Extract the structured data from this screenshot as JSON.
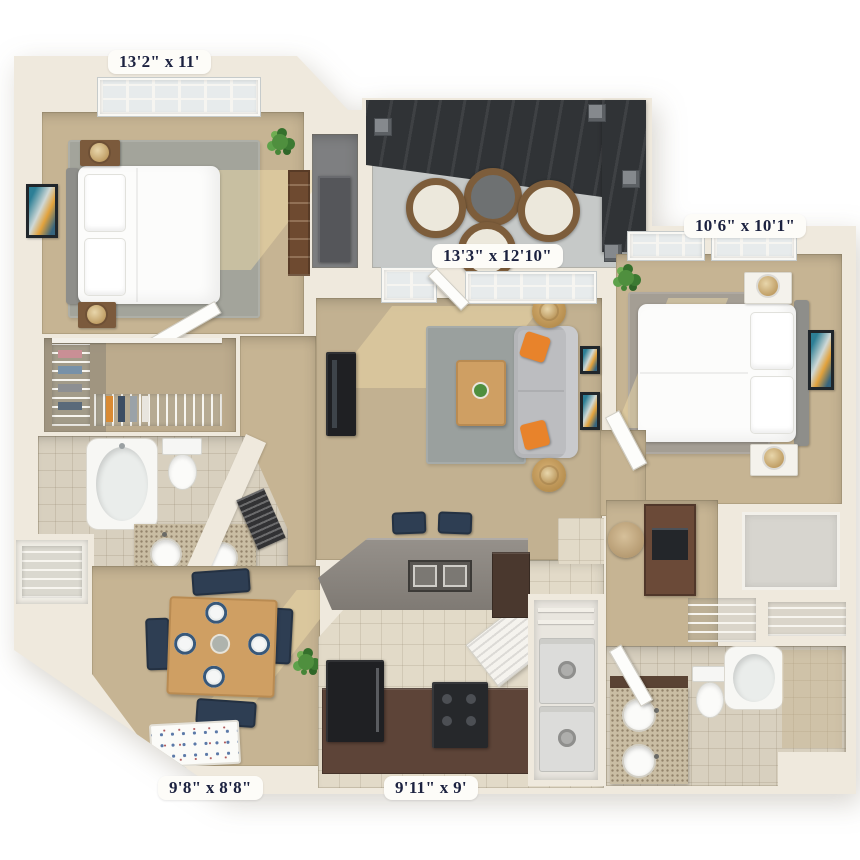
{
  "floor_plan": {
    "style": "3d-rendered top-down apartment floor plan on white background",
    "background_color": "#ffffff",
    "labels": [
      {
        "room": "bedroom-1",
        "text": "13'2\" x 11'"
      },
      {
        "room": "living-room",
        "text": "13'3\" x 12'10\""
      },
      {
        "room": "bedroom-2",
        "text": "10'6\" x 10'1\""
      },
      {
        "room": "dining-room",
        "text": "9'8\" x 8'8\""
      },
      {
        "room": "kitchen",
        "text": "9'11\" x 9'"
      }
    ],
    "label_style": {
      "text_color": "#1c2240",
      "pill_color": "#fdfcf8",
      "font": "serif bold"
    },
    "palette": {
      "walls": "#efe9dd",
      "carpet_tan": "#c6b493",
      "rug_gray": "#a3a49b",
      "kitchen_tile": "#e2dac8",
      "bath_tile": "#d8d0bf",
      "patio_concrete": "#c6c9c8",
      "pergola_dark": "#303336",
      "sofa_gray": "#bcbdc0",
      "accent_orange": "#e8832b",
      "chair_navy": "#2e3e53",
      "wood": "#cf9f63",
      "cabinet_brown": "#5d4438",
      "appliance_black": "#1f2023",
      "fixture_white": "#f7f7f4",
      "plant_green": "#4f8f3e"
    },
    "unlabeled_areas": [
      "balcony-patio-with-pergola",
      "walk-in-closet",
      "bathroom-1",
      "bathroom-2",
      "laundry-closet",
      "storage-closet",
      "entry-foyer",
      "hallway",
      "desk-nook",
      "linen-closet"
    ],
    "furnishings": {
      "bedroom_1": [
        "queen-bed",
        "two-nightstands",
        "lamps",
        "wall-art",
        "bookcase",
        "plant",
        "window"
      ],
      "bedroom_2": [
        "queen-bed",
        "two-nightstands",
        "lamps",
        "wall-art",
        "plant",
        "windows"
      ],
      "living_room": [
        "sofa-with-orange-pillows",
        "coffee-table",
        "two-side-tables",
        "tv-stand",
        "area-rug",
        "wall-frames"
      ],
      "dining_room": [
        "table-with-four-place-settings",
        "four-navy-chairs",
        "plant",
        "entry-doormat"
      ],
      "kitchen": [
        "breakfast-bar-with-double-sink",
        "two-bar-stools",
        "refrigerator",
        "range",
        "cabinets",
        "pantry"
      ],
      "patio": [
        "three-wicker-chairs",
        "round-wicker-table",
        "pergola"
      ],
      "bathroom_1": [
        "bathtub",
        "toilet",
        "double-sink-vanity"
      ],
      "bathroom_2": [
        "bathtub",
        "toilet",
        "double-sink-vanity"
      ],
      "laundry": [
        "washer",
        "dryer"
      ],
      "desk_nook": [
        "desk",
        "office-chair",
        "laptop"
      ]
    }
  }
}
